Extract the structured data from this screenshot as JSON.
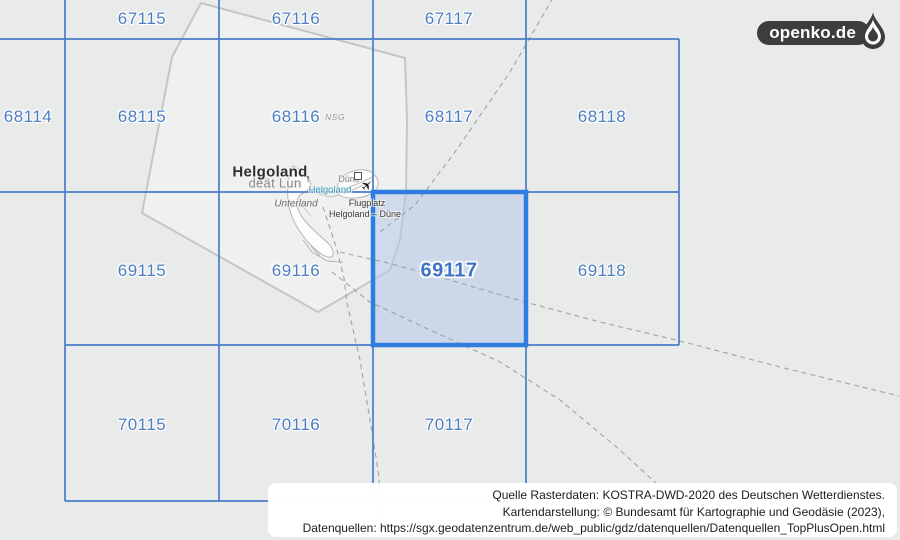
{
  "brand": {
    "logo_text": "openko.de"
  },
  "grid": {
    "selected_cell": "69117",
    "cells": [
      {
        "label": "67115"
      },
      {
        "label": "67116"
      },
      {
        "label": "67117"
      },
      {
        "label": "68114"
      },
      {
        "label": "68115"
      },
      {
        "label": "68116"
      },
      {
        "label": "68117"
      },
      {
        "label": "68118"
      },
      {
        "label": "69115"
      },
      {
        "label": "69116"
      },
      {
        "label": "69117"
      },
      {
        "label": "69118"
      },
      {
        "label": "70115"
      },
      {
        "label": "70116"
      },
      {
        "label": "70117"
      }
    ]
  },
  "map": {
    "labels": {
      "island_name": "Helgoland",
      "island_name_frisian": "deät Lun",
      "district": "Unterland",
      "dune_island": "Düne",
      "harbor": "Helgoland",
      "airfield_line1": "Flugplatz",
      "airfield_line2": "Helgoland – Düne",
      "protected_area": "NSG"
    },
    "icons": {
      "airplane": "✈",
      "monument": "↑"
    }
  },
  "attribution": {
    "line1": "Quelle Rasterdaten: KOSTRA-DWD-2020 des Deutschen Wetterdienstes.",
    "line2": "Kartendarstellung: © Bundesamt für Kartographie und Geodäsie (2023),",
    "line3": "Datenquellen: https://sgx.geodatenzentrum.de/web_public/gdz/datenquellen/Datenquellen_TopPlusOpen.html"
  },
  "colors": {
    "background": "#e9eaea",
    "grid_line": "#4b7cc8",
    "cell_label": "#4d7ec2",
    "selected_border": "#2f7de0",
    "selected_fill": "rgba(175,198,233,0.5)",
    "boundary_line": "#c6c6c6",
    "sea_boundary_dashed": "#9e9e9e",
    "logo_background": "#3d3d3d"
  }
}
